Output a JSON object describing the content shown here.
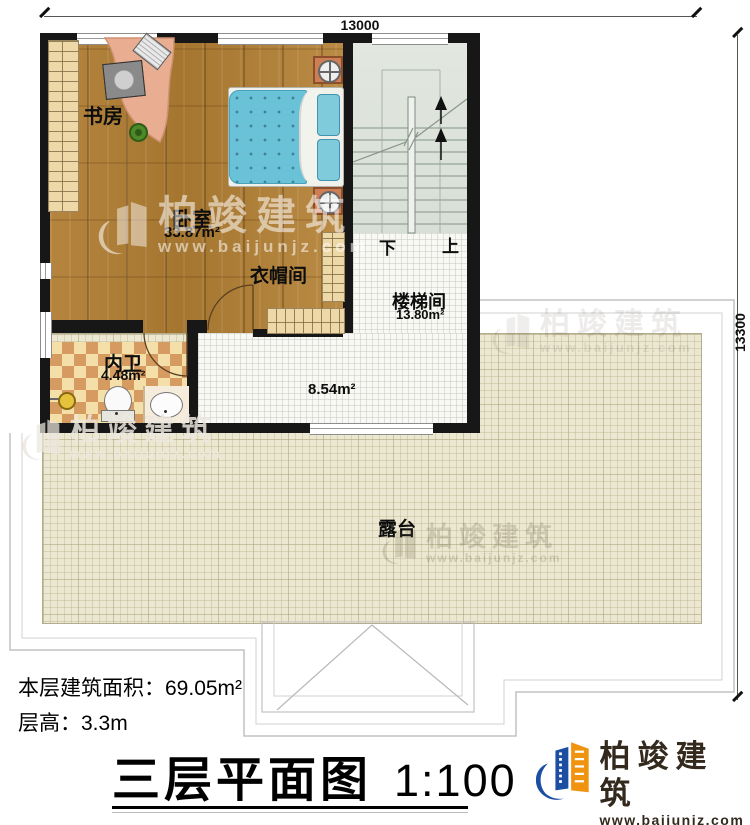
{
  "dimensions": {
    "top": "13000",
    "right": "13300"
  },
  "rooms": {
    "study": {
      "label": "书房"
    },
    "bedroom": {
      "label": "卧室",
      "area": "33.87m²"
    },
    "cloakroom": {
      "label": "衣帽间"
    },
    "bathroom": {
      "label": "内卫",
      "area": "4.48m²"
    },
    "stairwell": {
      "label": "楼梯间",
      "area": "13.80m²"
    },
    "hall": {
      "area": "8.54m²"
    },
    "terrace": {
      "label": "露台"
    }
  },
  "stairs": {
    "down_label": "下",
    "up_label": "上"
  },
  "info": {
    "area_line": "本层建筑面积：69.05m²",
    "height_line": "层高：3.3m"
  },
  "title": {
    "text": "三层平面图",
    "scale": "1:100"
  },
  "brand": {
    "name": "柏竣建筑",
    "site": "www.baijunjz.com"
  },
  "watermark": {
    "name": "柏竣建筑",
    "site": "www.baijunjz.com"
  },
  "colors": {
    "wall": "#171717",
    "wood": "#b0813e",
    "terrace": "#ece7d1",
    "stair": "#dde3d9",
    "tile_light": "#f4dfa9",
    "tile_dark": "#d69b60",
    "bed": "#6ac2d8",
    "desk": "#e9ad92",
    "brand_blue": "#1c4fa1",
    "brand_orange": "#f0930f"
  }
}
